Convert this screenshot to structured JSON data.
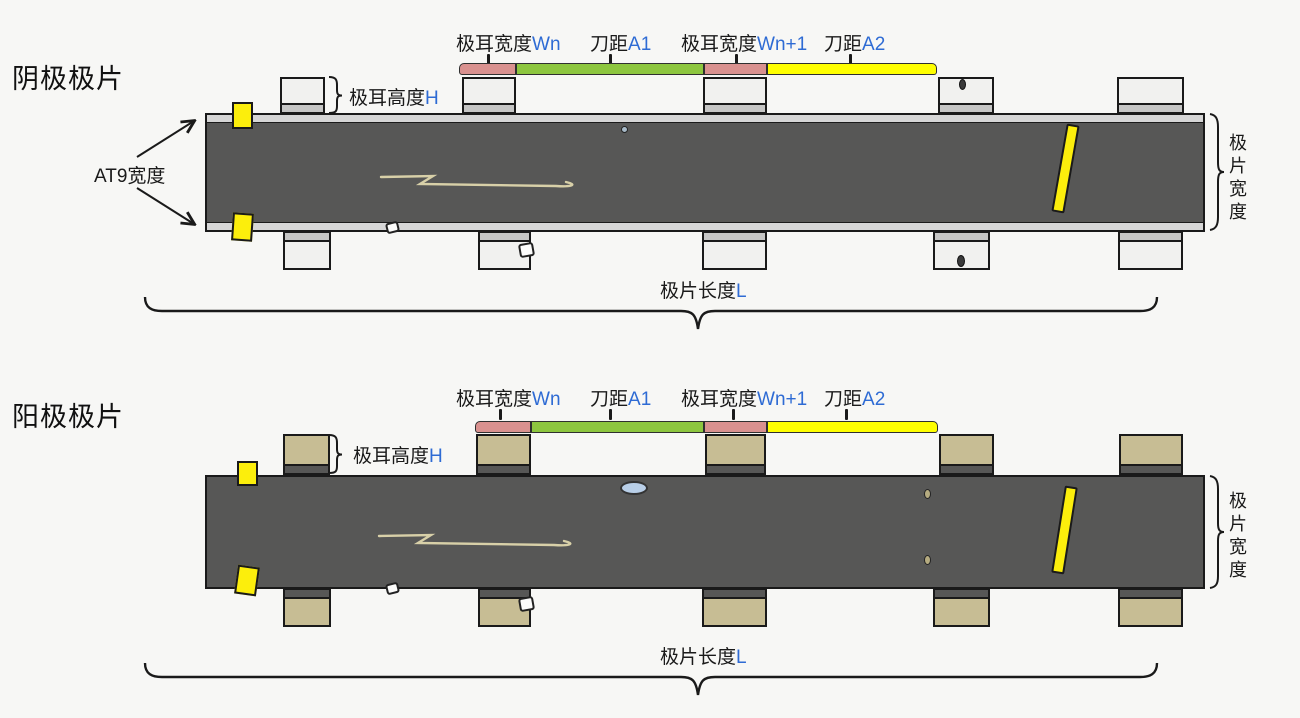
{
  "colors": {
    "background": "#f7f7f5",
    "outline": "#1a1a1a",
    "strip_dark": "#575756",
    "strip_edge_band": "#d6d6d6",
    "cathode_tab_body": "#f1f1ef",
    "cathode_tab_joint": "#c6c6c5",
    "anode_tab_body": "#c7bd94",
    "anode_tab_joint": "#575756",
    "bar_pink": "#d9918f",
    "bar_green": "#8dc63f",
    "bar_yellow": "#ffff00",
    "tape_yellow": "#fcee0c",
    "accent_blue": "#2e6bd4",
    "defect_blue": "#b9cfe8",
    "scratch": "#d8d0a8"
  },
  "cathode": {
    "title": "阴极极片",
    "dims": [
      {
        "label": "极耳宽度",
        "var": "Wn"
      },
      {
        "label": "刀距",
        "var": "A1"
      },
      {
        "label": "极耳宽度",
        "var": "Wn+1"
      },
      {
        "label": "刀距",
        "var": "A2"
      }
    ],
    "tab_height": {
      "label": "极耳高度",
      "var": "H"
    },
    "at9_label": "AT9宽度",
    "sheet_width_label": "极片宽度",
    "sheet_length": {
      "label": "极片长度",
      "var": "L"
    }
  },
  "anode": {
    "title": "阳极极片",
    "dims": [
      {
        "label": "极耳宽度",
        "var": "Wn"
      },
      {
        "label": "刀距",
        "var": "A1"
      },
      {
        "label": "极耳宽度",
        "var": "Wn+1"
      },
      {
        "label": "刀距",
        "var": "A2"
      }
    ],
    "tab_height": {
      "label": "极耳高度",
      "var": "H"
    },
    "sheet_width_label": "极片宽度",
    "sheet_length": {
      "label": "极片长度",
      "var": "L"
    }
  }
}
